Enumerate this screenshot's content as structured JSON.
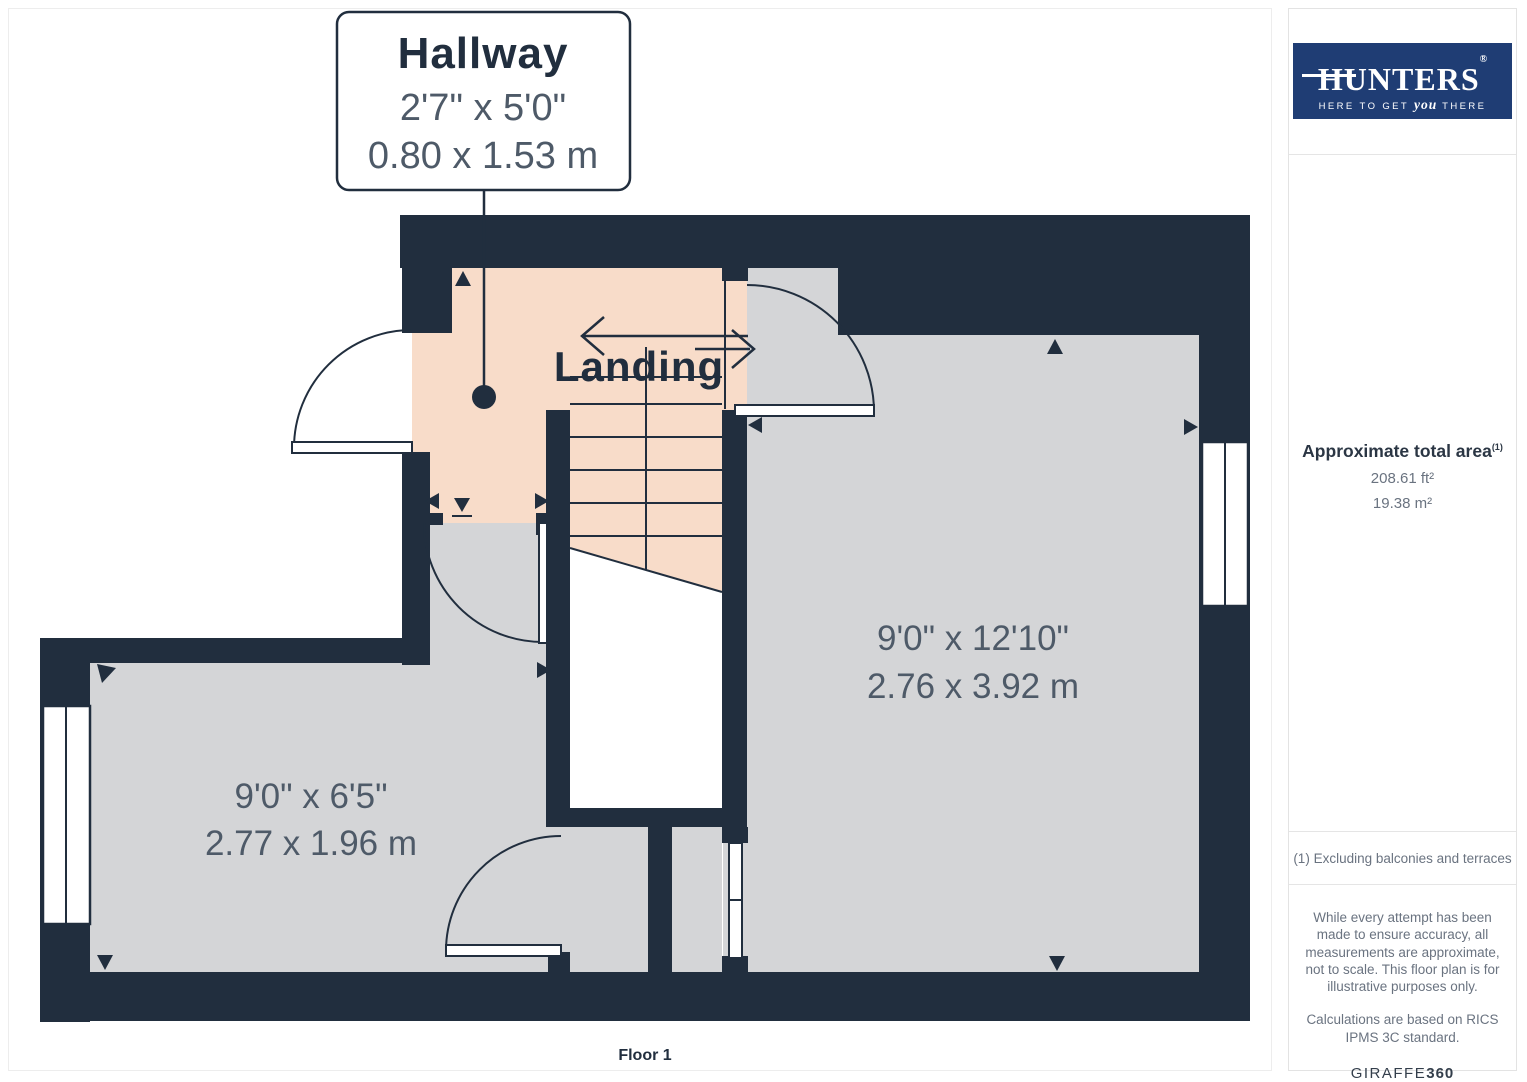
{
  "floor_plan": {
    "callout": {
      "room": "Hallway",
      "imperial": "2'7\" x 5'0\"",
      "metric": "0.80 x 1.53 m"
    },
    "landing_label": "Landing",
    "rooms": [
      {
        "id": "room-right",
        "imperial": "9'0\" x 12'10\"",
        "metric": "2.76 x 3.92 m"
      },
      {
        "id": "room-left",
        "imperial": "9'0\" x 6'5\"",
        "metric": "2.77 x 1.96 m"
      }
    ],
    "floor_label": "Floor 1",
    "colors": {
      "wall": "#212e3e",
      "floor": "#d4d5d7",
      "accent": "#f8dcc9",
      "dim": "#4e5a68",
      "brand": "#1f3d74"
    }
  },
  "sidebar": {
    "logo": {
      "brand": "HUNTERS",
      "registered": "®",
      "tagline_pre": "HERE TO GET",
      "tagline_emph": "you",
      "tagline_post": "THERE"
    },
    "area": {
      "title": "Approximate total area",
      "sup": "(1)",
      "imperial": "208.61 ft²",
      "metric": "19.38 m²"
    },
    "footnote": "(1) Excluding balconies and terraces",
    "disclaimer": "While every attempt has been made to ensure accuracy, all measurements are approximate, not to scale. This floor plan is for illustrative purposes only.",
    "standard": "Calculations are based on RICS IPMS 3C standard.",
    "credit": {
      "brand": "GIRAFFE",
      "suffix": "360"
    }
  }
}
